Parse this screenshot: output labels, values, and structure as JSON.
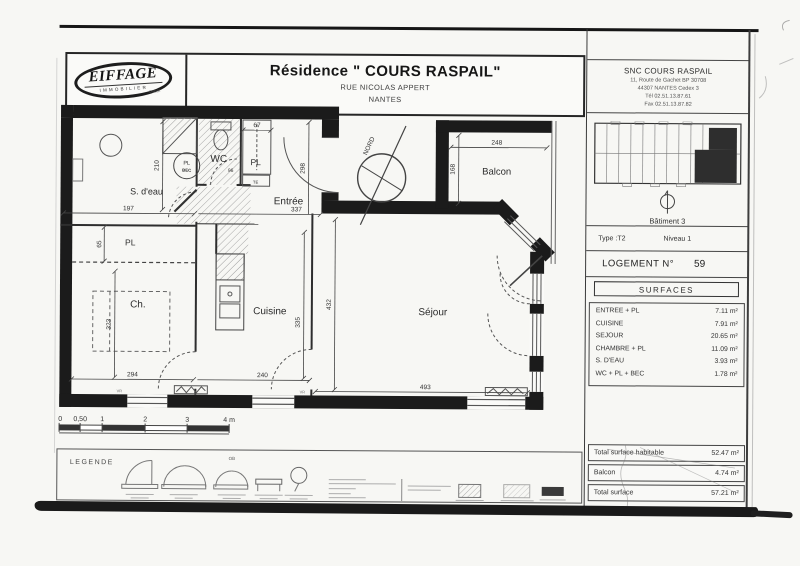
{
  "header": {
    "logo_line1": "EIFFAGE",
    "logo_line2": "IMMOBILIER",
    "logo_line3": "OUEST",
    "title": "Résidence \" COURS RASPAIL\"",
    "address_line": "RUE NICOLAS APPERT",
    "city": "NANTES"
  },
  "title_block": {
    "company_name": "SNC COURS RASPAIL",
    "company_address1": "11, Route de Gachet BP 30708",
    "company_address2": "44307 NANTES Cedex 3",
    "company_tel": "Tél 02.51.13.87.61",
    "company_fax": "Fax 02.51.13.87.82",
    "building": "Bâtiment 3",
    "type": "Type :T2",
    "level": "Niveau 1",
    "logement_label": "LOGEMENT N°",
    "logement_number": "59",
    "surfaces_title": "SURFACES",
    "surfaces": [
      {
        "label": "ENTREE + PL",
        "value": "7.11 m²"
      },
      {
        "label": "CUISINE",
        "value": "7.91 m²"
      },
      {
        "label": "SEJOUR",
        "value": "20.65 m²"
      },
      {
        "label": "CHAMBRE + PL",
        "value": "11.09 m²"
      },
      {
        "label": "S. D'EAU",
        "value": "3.93 m²"
      },
      {
        "label": "WC + PL + BEC",
        "value": "1.78 m²"
      }
    ],
    "totals": [
      {
        "label": "Total surface habitable",
        "value": "52.47 m²"
      },
      {
        "label": "Balcon",
        "value": "4.74 m²"
      },
      {
        "label": "Total surface",
        "value": "57.21 m²"
      }
    ]
  },
  "plan": {
    "north_label": "NORD",
    "rooms": {
      "sdeau": "S. d'eau",
      "pl_left": "PL",
      "wc": "WC",
      "pl_right": "PL",
      "pl_bec_line1": "PL",
      "pl_bec_line2": "BEC",
      "te": "TE",
      "entree": "Entrée",
      "balcon": "Balcon",
      "chambre": "Ch.",
      "cuisine": "Cuisine",
      "sejour": "Séjour"
    },
    "dims": {
      "sdeau_w": "197",
      "sdeau_h": "210",
      "pl_left_h": "65",
      "pl_right_w": "67",
      "wc_w": "96",
      "entree_w": "337",
      "entree_h": "298",
      "chambre_w": "294",
      "chambre_h": "323",
      "cuisine_w": "240",
      "cuisine_h": "335",
      "sejour_w": "493",
      "sejour_h": "432",
      "balcon_w": "248",
      "balcon_h": "168"
    },
    "window_labels": {
      "vr_left": "VR",
      "vr_right": "VR"
    }
  },
  "scale_bar": {
    "ticks": [
      "0",
      "0,50",
      "1",
      "2",
      "3",
      "4 m"
    ]
  },
  "legend": {
    "title": "LEGENDE",
    "ob_label": "OB"
  }
}
